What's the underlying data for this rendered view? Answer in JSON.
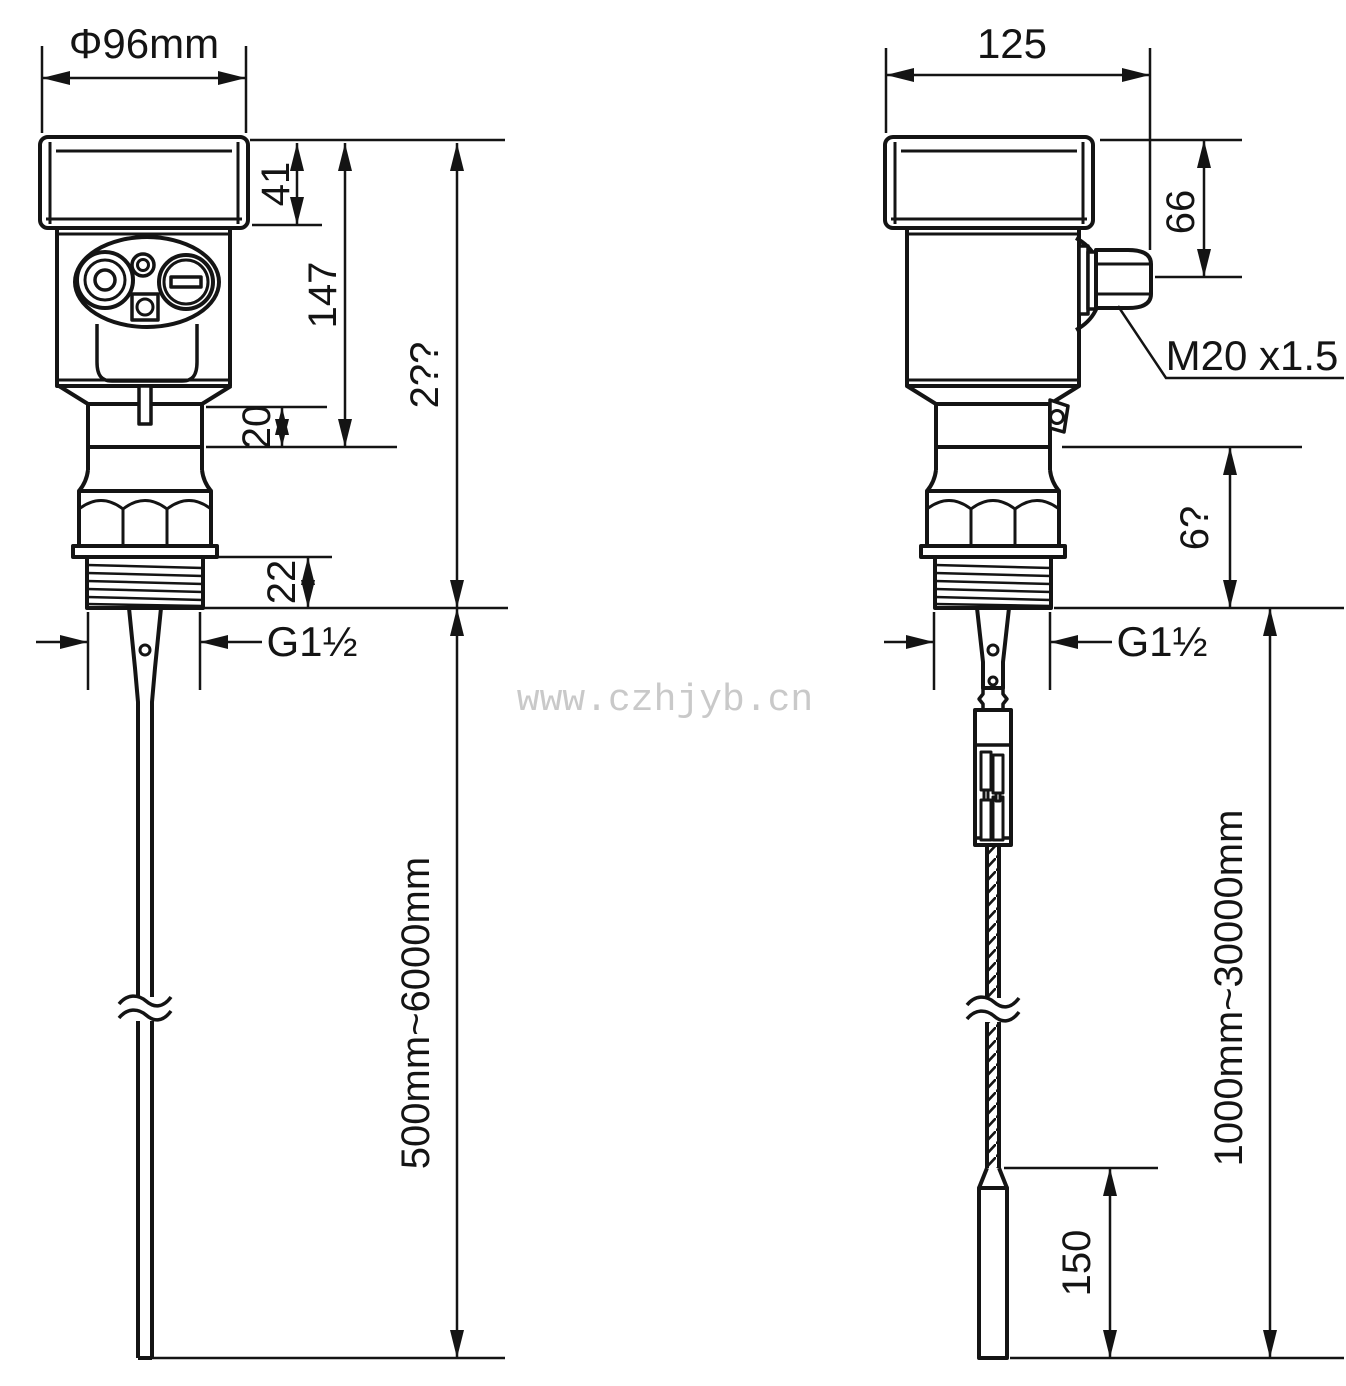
{
  "watermark": "www.czhjyb.cn",
  "front_view": {
    "cap_diameter": "Φ96mm",
    "cap_height": "41",
    "housing_height": "147",
    "head_total_height": "2??",
    "neck_height": "20",
    "thread_length": "22",
    "process_connection": "G1½",
    "probe_range": "500mm~6000mm"
  },
  "side_view": {
    "housing_width": "125",
    "cable_entry_offset": "66",
    "cable_entry_thread": "M20 x1.5",
    "lower_section_height": "6?",
    "process_connection": "G1½",
    "counterweight_length": "150",
    "cable_range": "1000mm~30000mm"
  }
}
